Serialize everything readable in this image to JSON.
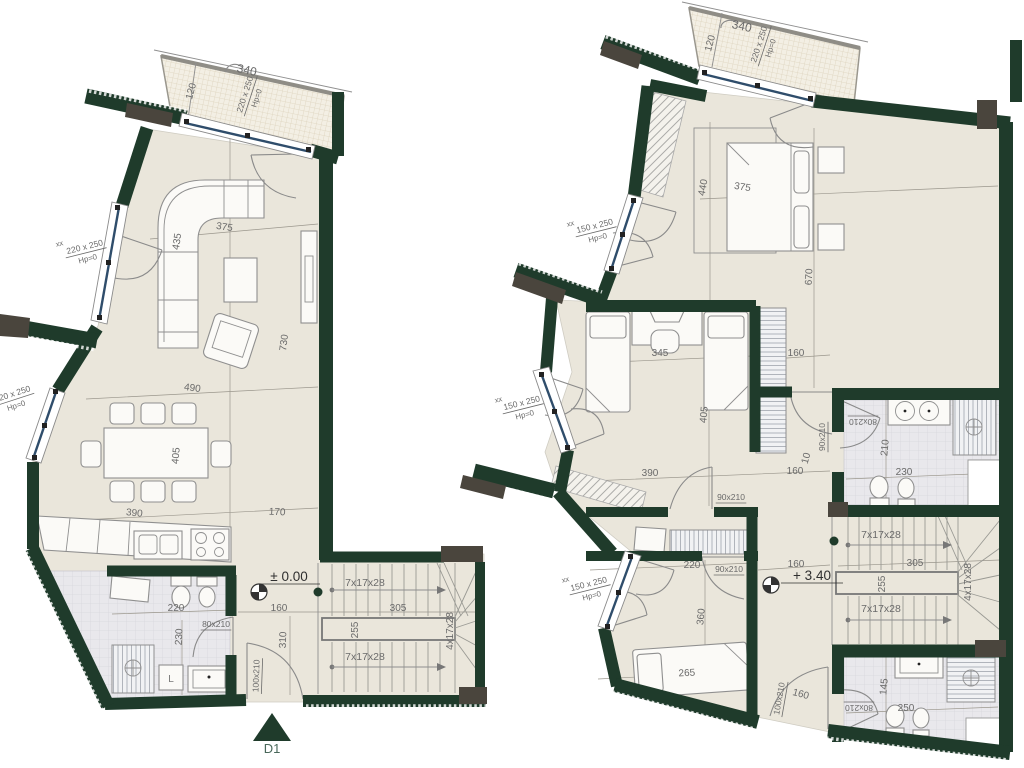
{
  "title": "Duplex apartment floor plans — ground level ±0.00 and upper level +3.40",
  "colors": {
    "wall": "#1f3b2b",
    "wall_gray": "#4a453d",
    "floor": "#eae6db",
    "tile": "#e9e8ec",
    "glass": "#2f4d6b",
    "dim_text": "#6a6a6a",
    "accent": "#2a4a38"
  },
  "levels": {
    "ground": "± 0.00",
    "upper": "+ 3.40"
  },
  "entry_marker": "D1",
  "labels": [
    {
      "t": "340",
      "x": 246,
      "y": 74,
      "r": 12,
      "s": 12,
      "n": "dim-balcony-340-left"
    },
    {
      "t": "120",
      "x": 194,
      "y": 92,
      "r": -75,
      "s": 10,
      "n": "dim-balcony-120-left"
    },
    {
      "top": "220 x 250",
      "bot": "Hp=0",
      "x": 250,
      "y": 96,
      "r": -72,
      "s": 8.5,
      "n": "window-size-balcony-left"
    },
    {
      "t": "375",
      "x": 224,
      "y": 230,
      "r": 9,
      "s": 10,
      "n": "dim-living-375"
    },
    {
      "t": "435",
      "x": 180,
      "y": 242,
      "r": -81,
      "s": 10,
      "n": "dim-living-435"
    },
    {
      "t": "730",
      "x": 287,
      "y": 343,
      "r": -83,
      "s": 10,
      "n": "dim-living-730"
    },
    {
      "t": "490",
      "x": 192,
      "y": 391,
      "r": 7,
      "s": 10,
      "n": "dim-dining-490"
    },
    {
      "t": "405",
      "x": 179,
      "y": 456,
      "r": -85,
      "s": 10,
      "n": "dim-dining-405"
    },
    {
      "t": "390",
      "x": 134,
      "y": 516,
      "r": 6,
      "s": 10,
      "n": "dim-kitchen-390"
    },
    {
      "t": "170",
      "x": 277,
      "y": 515,
      "r": 3,
      "s": 10,
      "n": "dim-hall-170"
    },
    {
      "t": "xx",
      "x": 60,
      "y": 246,
      "r": -14,
      "s": 7.5,
      "n": "window-mark-xx"
    },
    {
      "top": "220 x 250",
      "bot": "Hp=0",
      "x": 86,
      "y": 252,
      "r": -14,
      "s": 8.5,
      "n": "window-size-living-left"
    },
    {
      "top": "220 x 250",
      "bot": "Hp=0",
      "x": 14,
      "y": 399,
      "r": -18,
      "s": 8.5,
      "n": "window-size-dining-left"
    },
    {
      "t": "220",
      "x": 176,
      "y": 611,
      "s": 10,
      "n": "dim-bath-220"
    },
    {
      "t": "230",
      "x": 182,
      "y": 637,
      "r": -87,
      "s": 10,
      "n": "dim-bath-230"
    },
    {
      "t": "80x210",
      "x": 216,
      "y": 627,
      "s": 8.5,
      "u": 1,
      "n": "door-size-bath-ground"
    },
    {
      "t": "± 0.00",
      "x": 289,
      "y": 581,
      "s": 13.5,
      "c": "#2f2f2f",
      "u": 1,
      "ul": 62,
      "n": "level-marker-ground-text"
    },
    {
      "t": "160",
      "x": 279,
      "y": 611,
      "s": 10,
      "n": "dim-hall-160-ground"
    },
    {
      "t": "310",
      "x": 286,
      "y": 640,
      "r": -88,
      "s": 10,
      "n": "dim-hall-310"
    },
    {
      "t": "100x210",
      "x": 259,
      "y": 676,
      "r": -88,
      "s": 8.5,
      "u": 1,
      "n": "door-size-entry-ground"
    },
    {
      "t": "7x17x28",
      "x": 365,
      "y": 586,
      "s": 10.5,
      "n": "stair-flight-upper-ground"
    },
    {
      "t": "305",
      "x": 398,
      "y": 611,
      "s": 10,
      "n": "dim-stair-305-ground"
    },
    {
      "t": "255",
      "x": 358,
      "y": 630,
      "r": -90,
      "s": 10,
      "n": "dim-stair-255-ground"
    },
    {
      "t": "7x17x28",
      "x": 365,
      "y": 660,
      "s": 10.5,
      "n": "stair-flight-lower-ground"
    },
    {
      "t": "4x17x28",
      "x": 453,
      "y": 631,
      "r": -90,
      "s": 10,
      "n": "stair-winder-ground"
    },
    {
      "t": "L",
      "x": 171,
      "y": 682,
      "s": 10,
      "c": "#777777",
      "n": "washer-label"
    },
    {
      "t": "D1",
      "x": 272,
      "y": 753,
      "s": 13,
      "c": "#49685a",
      "n": "entry-marker-text"
    },
    {
      "t": "340",
      "x": 741,
      "y": 30,
      "r": 12,
      "s": 12,
      "n": "dim-balcony-340-right"
    },
    {
      "t": "120",
      "x": 713,
      "y": 44,
      "r": -75,
      "s": 10,
      "n": "dim-balcony-120-right"
    },
    {
      "top": "220 x 250",
      "bot": "Hp=0",
      "x": 764,
      "y": 46,
      "r": -72,
      "s": 8.5,
      "n": "window-size-balcony-right"
    },
    {
      "t": "440",
      "x": 706,
      "y": 188,
      "r": -80,
      "s": 10,
      "n": "dim-master-440"
    },
    {
      "t": "375",
      "x": 742,
      "y": 190,
      "r": 9,
      "s": 10,
      "n": "dim-master-375"
    },
    {
      "t": "670",
      "x": 812,
      "y": 277,
      "r": -87,
      "s": 10,
      "n": "dim-master-670"
    },
    {
      "t": "xx",
      "x": 571,
      "y": 226,
      "r": -14,
      "s": 7.5,
      "n": "window-mark-xx"
    },
    {
      "top": "150 x 250",
      "bot": "Hp=0",
      "x": 596,
      "y": 231,
      "r": -14,
      "s": 8.5,
      "n": "window-size-master"
    },
    {
      "t": "345",
      "x": 660,
      "y": 356,
      "s": 10,
      "n": "dim-bed2-345"
    },
    {
      "t": "405",
      "x": 707,
      "y": 415,
      "r": -85,
      "s": 10,
      "n": "dim-bed2-405"
    },
    {
      "t": "160",
      "x": 796,
      "y": 356,
      "s": 10,
      "n": "dim-hall-160-a"
    },
    {
      "t": "390",
      "x": 650,
      "y": 476,
      "s": 10,
      "n": "dim-bed2-390"
    },
    {
      "t": "160",
      "x": 795,
      "y": 474,
      "s": 10,
      "n": "dim-hall-160-b"
    },
    {
      "t": "90x210",
      "x": 731,
      "y": 500,
      "s": 8.5,
      "u": 1,
      "n": "door-size-bed2"
    },
    {
      "t": "90x210",
      "x": 825,
      "y": 437,
      "r": -90,
      "s": 8.5,
      "u": 1,
      "n": "door-size-bath1"
    },
    {
      "t": "10",
      "x": 809,
      "y": 459,
      "r": -75,
      "s": 10,
      "n": "dim-10"
    },
    {
      "t": "80x210",
      "x": 863,
      "y": 419,
      "r": 180,
      "s": 8.5,
      "u": 1,
      "n": "door-size-bath1-inner"
    },
    {
      "t": "210",
      "x": 888,
      "y": 448,
      "r": -85,
      "s": 10,
      "n": "dim-bath1-210"
    },
    {
      "t": "230",
      "x": 904,
      "y": 475,
      "s": 10,
      "n": "dim-bath1-230"
    },
    {
      "t": "xx",
      "x": 499,
      "y": 402,
      "r": -14,
      "s": 7.5,
      "n": "window-mark-xx"
    },
    {
      "top": "150 x 250",
      "bot": "Hp=0",
      "x": 523,
      "y": 408,
      "r": -14,
      "s": 8.5,
      "n": "window-size-bed2"
    },
    {
      "t": "220",
      "x": 692,
      "y": 568,
      "s": 10,
      "n": "dim-bed3-220"
    },
    {
      "t": "90x210",
      "x": 729,
      "y": 572,
      "s": 8.5,
      "u": 1,
      "n": "door-size-bed3"
    },
    {
      "t": "xx",
      "x": 566,
      "y": 582,
      "r": -14,
      "s": 7.5,
      "n": "window-mark-xx"
    },
    {
      "top": "150 x 250",
      "bot": "Hp=0",
      "x": 590,
      "y": 589,
      "r": -14,
      "s": 8.5,
      "n": "window-size-bed3"
    },
    {
      "t": "360",
      "x": 704,
      "y": 617,
      "r": -85,
      "s": 10,
      "n": "dim-bed3-360"
    },
    {
      "t": "265",
      "x": 687,
      "y": 676,
      "r": -3,
      "s": 10,
      "n": "dim-bed3-265"
    },
    {
      "t": "+ 3.40",
      "x": 812,
      "y": 580,
      "s": 13.5,
      "c": "#2f2f2f",
      "u": 1,
      "ul": 62,
      "n": "level-marker-upper-text"
    },
    {
      "t": "160",
      "x": 796,
      "y": 567,
      "s": 10,
      "n": "dim-hall-160-upper"
    },
    {
      "t": "7x17x28",
      "x": 881,
      "y": 538,
      "s": 10.5,
      "n": "stair-flight-upper-upper"
    },
    {
      "t": "305",
      "x": 915,
      "y": 566,
      "s": 10,
      "n": "dim-stair-305-upper"
    },
    {
      "t": "255",
      "x": 885,
      "y": 584,
      "r": -90,
      "s": 10,
      "n": "dim-stair-255-upper"
    },
    {
      "t": "7x17x28",
      "x": 881,
      "y": 612,
      "s": 10.5,
      "n": "stair-flight-lower-upper"
    },
    {
      "t": "4x17x28",
      "x": 971,
      "y": 582,
      "r": -90,
      "s": 10,
      "n": "stair-winder-upper"
    },
    {
      "t": "100x210",
      "x": 782,
      "y": 699,
      "r": -80,
      "s": 8.5,
      "u": 1,
      "n": "door-size-stair-upper"
    },
    {
      "t": "160",
      "x": 800,
      "y": 697,
      "r": 15,
      "s": 10,
      "n": "dim-160-entry-upper"
    },
    {
      "t": "80x210",
      "x": 859,
      "y": 705,
      "r": 180,
      "s": 8.5,
      "u": 1,
      "n": "door-size-bath2"
    },
    {
      "t": "145",
      "x": 887,
      "y": 687,
      "r": -85,
      "s": 10,
      "n": "dim-bath2-145"
    },
    {
      "t": "250",
      "x": 906,
      "y": 711,
      "s": 10,
      "n": "dim-bath2-250"
    }
  ]
}
